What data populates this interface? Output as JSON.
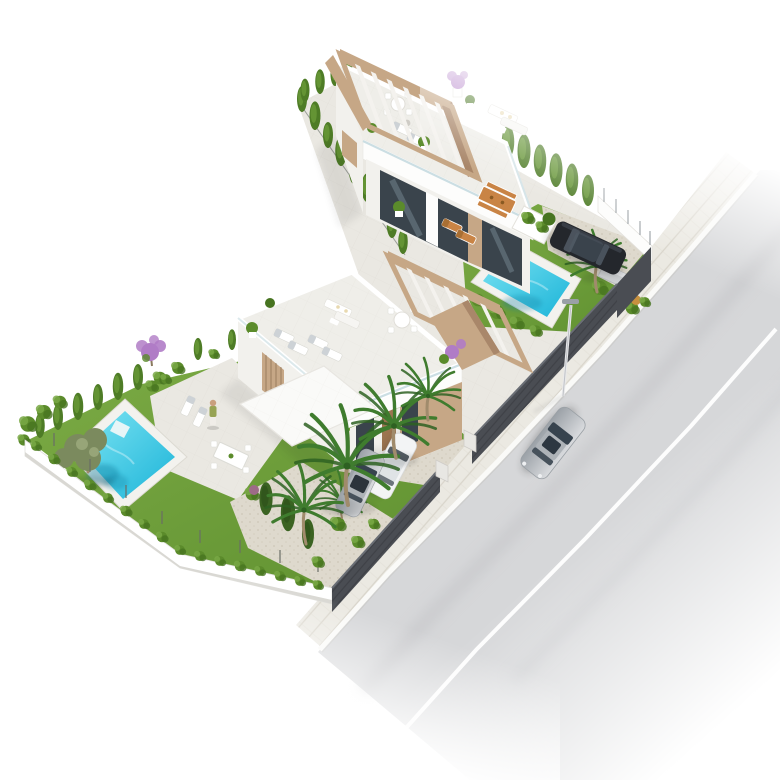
{
  "scene": {
    "title": "aerial-3d-render-two-villas",
    "description": "Isometric aerial 3D architectural visualization on a white background: two modern white flat-roof villas on an L-shaped plot with rooftop terraces, wooden pergolas, turquoise pools, lawns, cypress hedges, palm trees, parked cars behind a dark fence, and a street with sidewalk, street lamp and a driving silver car",
    "counts": {
      "villas": 2,
      "pools": 2,
      "cars": 4,
      "people": 1,
      "street_lamps": 1
    },
    "objects": {
      "upper_villa": "white villa with roof terrace, slatted wooden pergola, glass railing, round table, loungers and sofa set",
      "upper_patio": "tiled patio with wooden dining table, benches and two wooden sun loungers",
      "upper_pool": "turquoise pool with white deck on a lawn beside a gravel parking with a dark parked car and palm",
      "lower_villa": "white villa with roof terrace, pergola, four loungers, outdoor sofa and round dining table",
      "lower_patio": "tiled terrace with white loungers, a standing person and a white dining table",
      "lower_pool": "turquoise pool with white deck and corner steps, olive tree nearby",
      "garden": "lawns, gravel planting beds, conifers, shrubs, purple blossom trees, tall palms",
      "driveway": "gravel driveway with a silver car and a white car behind a dark slatted fence",
      "street": "light asphalt road with white lane line, paved sidewalk, white kerb, dark boundary fence with gate, street lamp, driving silver car"
    }
  },
  "colors": {
    "bg": "#ffffff",
    "tile": "#eae8e2",
    "roofDeck": "#efeee9",
    "wallWhite": "#fdfdfc",
    "wallShade": "#f2f1ed",
    "wood": "#c6a786",
    "woodDark": "#a9876a",
    "glassDark": "#3a444c",
    "glassLight": "#9fb4c0",
    "lawnLight": "#7cab45",
    "lawnDark": "#5f9030",
    "hedge": "#5b8b2b",
    "hedgeLight": "#79a845",
    "hedgeDark": "#477420",
    "cypress": "#4e7c26",
    "cypressLight": "#6c9c3a",
    "conifer": "#3b6322",
    "coniferDark": "#2f531c",
    "olive": "#7b8a5e",
    "oliveLight": "#97a578",
    "palmGreen": "#3f7c2e",
    "palmDark": "#2e6122",
    "trunk": "#a08b6c",
    "poolLight": "#7ce4f3",
    "poolDeep": "#1cb4d8",
    "deck": "#f3f2ee",
    "gravel": "#ded9cd",
    "fenceDark": "#4a4d53",
    "road": "#d6d7d9",
    "sidewalk": "#ebe9e2",
    "sidewalkLine": "#d9d5cb",
    "kerb": "#fafaf8",
    "carDark": "#24272c",
    "carSilverLight": "#d9dbde",
    "carSilverDark": "#9ba1a7",
    "carWhite": "#f3f4f5",
    "purple": "#b07cc6",
    "furnWood": "#c98445",
    "skin": "#c99f7e",
    "shirt": "#97a354",
    "railGlass": "#c5dae0"
  }
}
